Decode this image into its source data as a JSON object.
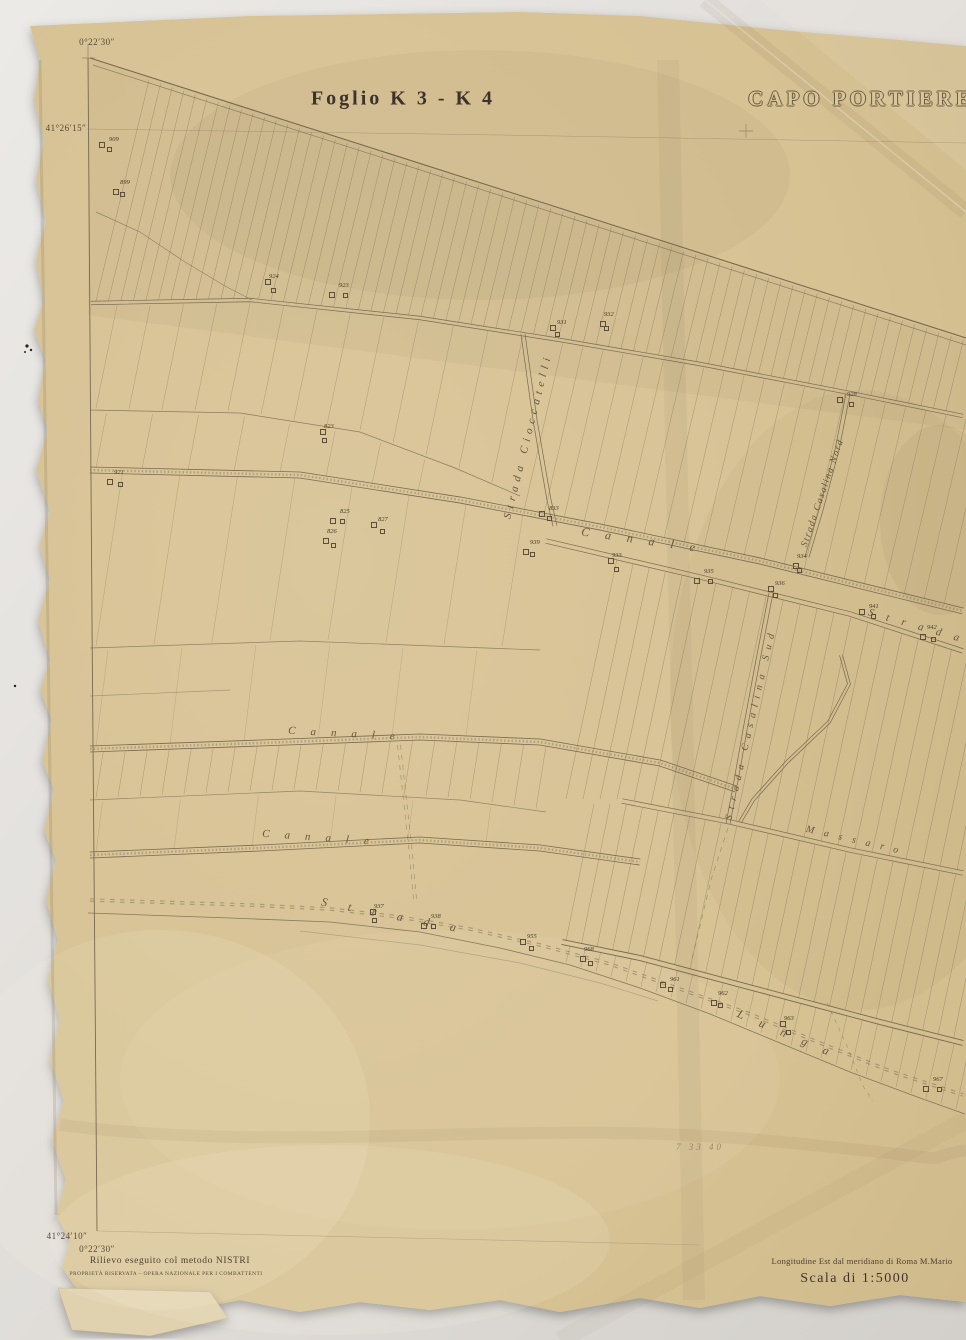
{
  "titles": {
    "sheet": "Foglio  K 3 - K 4",
    "place": "CAPO PORTIERE"
  },
  "corners": {
    "top_lon": "0°22′30″",
    "top_lat": "41°26′15″",
    "bottom_lat": "41°24′10″",
    "bottom_lon": "0°22′30″"
  },
  "footer": {
    "method": "Rilievo eseguito col metodo NISTRI",
    "property": "PROPRIETÀ RISERVATA – OPERA NAZIONALE PER I COMBATTENTI",
    "longitude_note": "Longitudine Est dal meridiano di Roma M.Mario",
    "scale": "Scala di 1:5000",
    "pencil_note": "7 33 40"
  },
  "road_labels": [
    {
      "id": "strada-cioccatelli",
      "text": "Strada Cioccatelli",
      "x": 528,
      "y": 436,
      "rot": -76,
      "ls": 5,
      "fs": 11
    },
    {
      "id": "canale-upper",
      "text": "Canale",
      "x": 646,
      "y": 541,
      "rot": 8,
      "ls": 16,
      "fs": 12
    },
    {
      "id": "strada-casalina-nord",
      "text": "Strada Casalina Nord",
      "x": 823,
      "y": 493,
      "rot": -71,
      "ls": 1.5,
      "fs": 9.5
    },
    {
      "id": "strada-casalina-sud",
      "text": "Strada Casalina Sud",
      "x": 751,
      "y": 724,
      "rot": -77,
      "ls": 6,
      "fs": 10
    },
    {
      "id": "strada-right",
      "text": "Strada",
      "x": 920,
      "y": 627,
      "rot": 16,
      "ls": 13,
      "fs": 11
    },
    {
      "id": "canale-mid",
      "text": "Canale",
      "x": 349,
      "y": 734,
      "rot": 3,
      "ls": 15,
      "fs": 11
    },
    {
      "id": "canale-lower",
      "text": "Canale",
      "x": 323,
      "y": 838,
      "rot": 4,
      "ls": 15,
      "fs": 11
    },
    {
      "id": "massaro",
      "text": "Massaro",
      "x": 857,
      "y": 841,
      "rot": 13,
      "ls": 10,
      "fs": 10
    },
    {
      "id": "strada-coast",
      "text": "Strada",
      "x": 399,
      "y": 917,
      "rot": 11,
      "ls": 21,
      "fs": 12
    },
    {
      "id": "lunga",
      "text": "Lunga",
      "x": 791,
      "y": 1036,
      "rot": 23,
      "ls": 17,
      "fs": 12
    }
  ],
  "parcel_markers": [
    {
      "label": "909",
      "x": 103,
      "y": 144
    },
    {
      "label": "899",
      "x": 114,
      "y": 187
    },
    {
      "label": "924",
      "x": 263,
      "y": 281
    },
    {
      "label": "923",
      "x": 333,
      "y": 290
    },
    {
      "label": "931",
      "x": 551,
      "y": 327
    },
    {
      "label": "932",
      "x": 598,
      "y": 319
    },
    {
      "label": "928",
      "x": 841,
      "y": 399
    },
    {
      "label": "921",
      "x": 108,
      "y": 477
    },
    {
      "label": "823",
      "x": 318,
      "y": 431
    },
    {
      "label": "825",
      "x": 334,
      "y": 516
    },
    {
      "label": "827",
      "x": 372,
      "y": 524
    },
    {
      "label": "826",
      "x": 321,
      "y": 536
    },
    {
      "label": "833",
      "x": 543,
      "y": 513
    },
    {
      "label": "939",
      "x": 524,
      "y": 547
    },
    {
      "label": "933",
      "x": 606,
      "y": 560
    },
    {
      "label": "935",
      "x": 698,
      "y": 576
    },
    {
      "label": "936",
      "x": 769,
      "y": 588
    },
    {
      "label": "934",
      "x": 791,
      "y": 561
    },
    {
      "label": "941",
      "x": 863,
      "y": 611
    },
    {
      "label": "942",
      "x": 921,
      "y": 632
    },
    {
      "label": "937",
      "x": 368,
      "y": 911
    },
    {
      "label": "938",
      "x": 425,
      "y": 921
    },
    {
      "label": "955",
      "x": 521,
      "y": 941
    },
    {
      "label": "968",
      "x": 578,
      "y": 954
    },
    {
      "label": "961",
      "x": 664,
      "y": 984
    },
    {
      "label": "962",
      "x": 712,
      "y": 998
    },
    {
      "label": "963",
      "x": 778,
      "y": 1023
    },
    {
      "label": "967",
      "x": 927,
      "y": 1084
    }
  ],
  "colors": {
    "ink": "#7a6950",
    "ink_dark": "#5d4e38",
    "paper": "#d6c293",
    "background": "#e4e1dd"
  }
}
